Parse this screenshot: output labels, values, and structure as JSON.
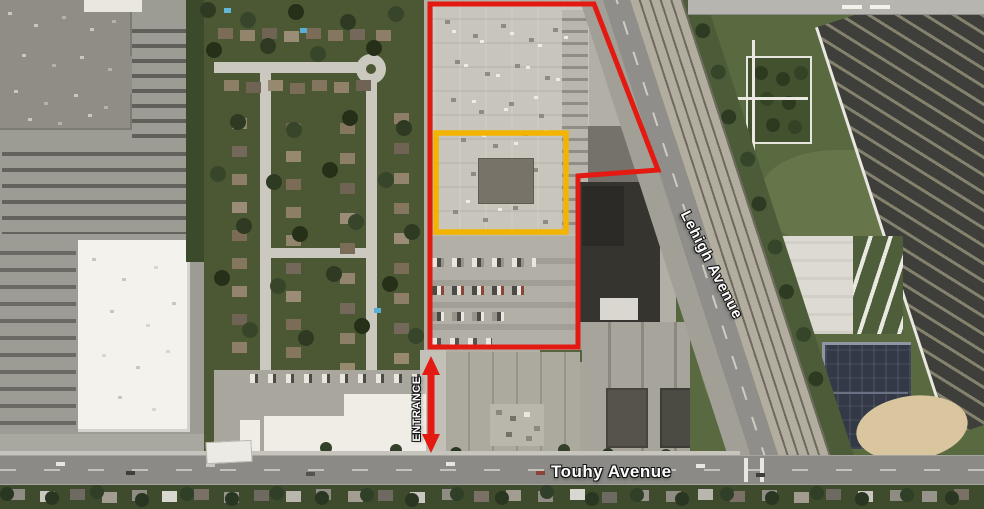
{
  "map_labels": {
    "lehigh": "Lehigh Avenue",
    "touhy": "Touhy Avenue",
    "entrance": "ENTRANCE"
  },
  "annotations": {
    "boundary_color": "#e31a12",
    "highlight_color": "#f2b400",
    "arrow_color": "#e31a12"
  }
}
